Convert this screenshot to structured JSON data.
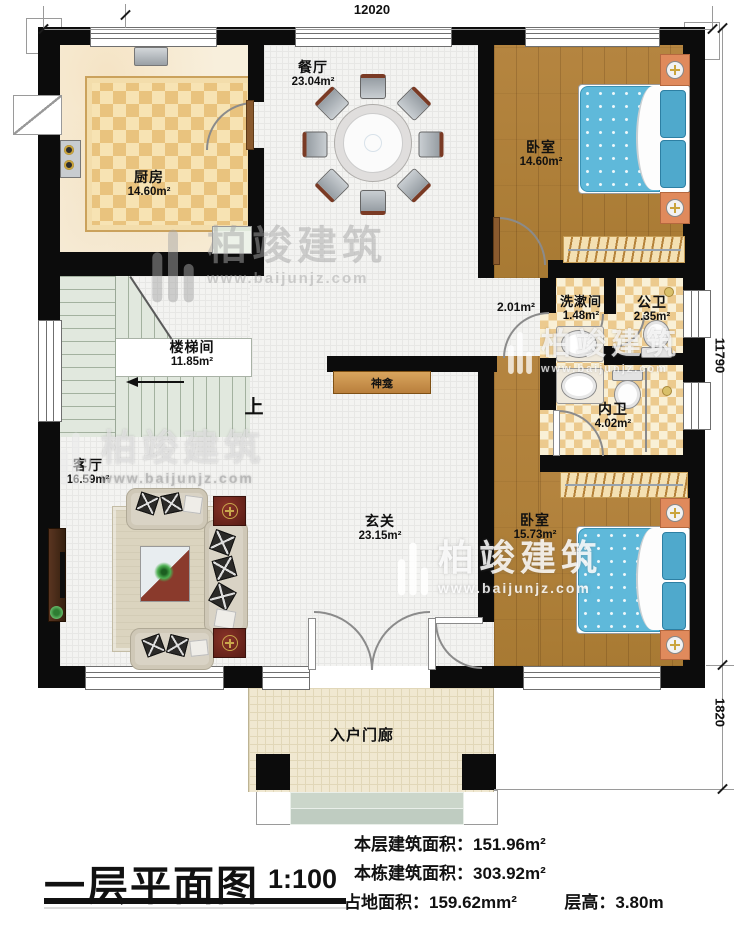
{
  "plan": {
    "dimensions": {
      "width_top": "12020",
      "height_right": "11790",
      "porch_height": "1820"
    },
    "rooms": {
      "dining": {
        "name": "餐厅",
        "area": "23.04m²"
      },
      "kitchen": {
        "name": "厨房",
        "area": "14.60m²"
      },
      "bedroom_top": {
        "name": "卧室",
        "area": "14.60m²"
      },
      "stairwell": {
        "name": "楼梯间",
        "area": "11.85m²"
      },
      "washroom": {
        "name": "洗漱间",
        "area": "1.48m²"
      },
      "public_wc": {
        "name": "公卫",
        "area": "2.35m²"
      },
      "private_wc": {
        "name": "内卫",
        "area": "4.02m²"
      },
      "living": {
        "name": "客厅",
        "area": "16.59m²"
      },
      "foyer": {
        "name": "玄关",
        "area": "23.15m²"
      },
      "bedroom_bottom": {
        "name": "卧室",
        "area": "15.73m²"
      },
      "porch": {
        "name": "入户门廊"
      }
    },
    "annotations": {
      "hall_area": "2.01m²",
      "shrine": "神龛",
      "stairs_up": "上"
    }
  },
  "watermark": {
    "brand": "柏竣建筑",
    "url": "www.baijunjz.com"
  },
  "title_block": {
    "title": "一层平面图",
    "scale": "1:100",
    "stats": [
      {
        "label": "本层建筑面积：",
        "value": "151.96m²"
      },
      {
        "label": "本栋建筑面积：",
        "value": "303.92m²"
      },
      {
        "label": "占地面积：",
        "value": "159.62mm²"
      },
      {
        "label": "层高：",
        "value": "3.80m"
      }
    ]
  }
}
